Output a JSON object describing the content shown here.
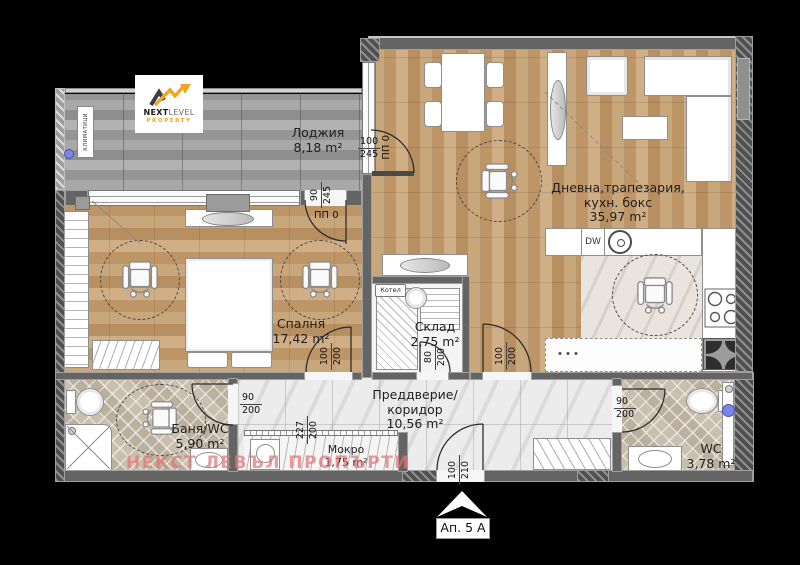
{
  "apartment": {
    "unit_label": "Ап. 5 А"
  },
  "branding": {
    "logo_top": "NEXT",
    "logo_top2": "LEVEL",
    "logo_sub": "PROPERTY",
    "watermark_text": "НЕКСТ ЛЕВЪЛ ПРОПЪРТИ",
    "accent_yellow": "#f2a51e",
    "watermark_pink": "#e07676"
  },
  "rooms": {
    "loggia": {
      "name": "Лоджия",
      "area": "8,18 m²"
    },
    "living": {
      "name1": "Дневна,трапезария,",
      "name2": "кухн. бокс",
      "area": "35,97 m²"
    },
    "bedroom": {
      "name": "Спалня",
      "area": "17,42 m²"
    },
    "storage": {
      "name": "Склад",
      "area": "2,75 m²"
    },
    "hallway": {
      "name1": "Преддверие/",
      "name2": "коридор",
      "area": "10,56 m²"
    },
    "bathroom": {
      "name": "Баня/WC",
      "area": "5,90 m²"
    },
    "wet_room": {
      "name": "Мокро",
      "area": "1,75 m²"
    },
    "wc": {
      "name": "WC",
      "area": "3,78 m²"
    }
  },
  "equipment": {
    "boiler": "Котел",
    "air_conditioners": "КЛИМАТИЦИ",
    "dishwasher": "DW"
  },
  "openings": {
    "loggia_living": {
      "w": "100",
      "h": "245",
      "note": "ПП 0"
    },
    "loggia_bedroom": {
      "w": "90",
      "h": "245",
      "note": "ПП 0"
    },
    "bedroom_door": {
      "w": "100",
      "h": "200"
    },
    "storage_door": {
      "w": "80",
      "h": "200"
    },
    "living_door": {
      "w": "100",
      "h": "200"
    },
    "bathroom_door": {
      "w": "90",
      "h": "200"
    },
    "wet_opening": {
      "w": "227",
      "h": "200"
    },
    "wc_door": {
      "w": "90",
      "h": "200"
    },
    "entrance": {
      "w": "100",
      "h": "210"
    }
  }
}
